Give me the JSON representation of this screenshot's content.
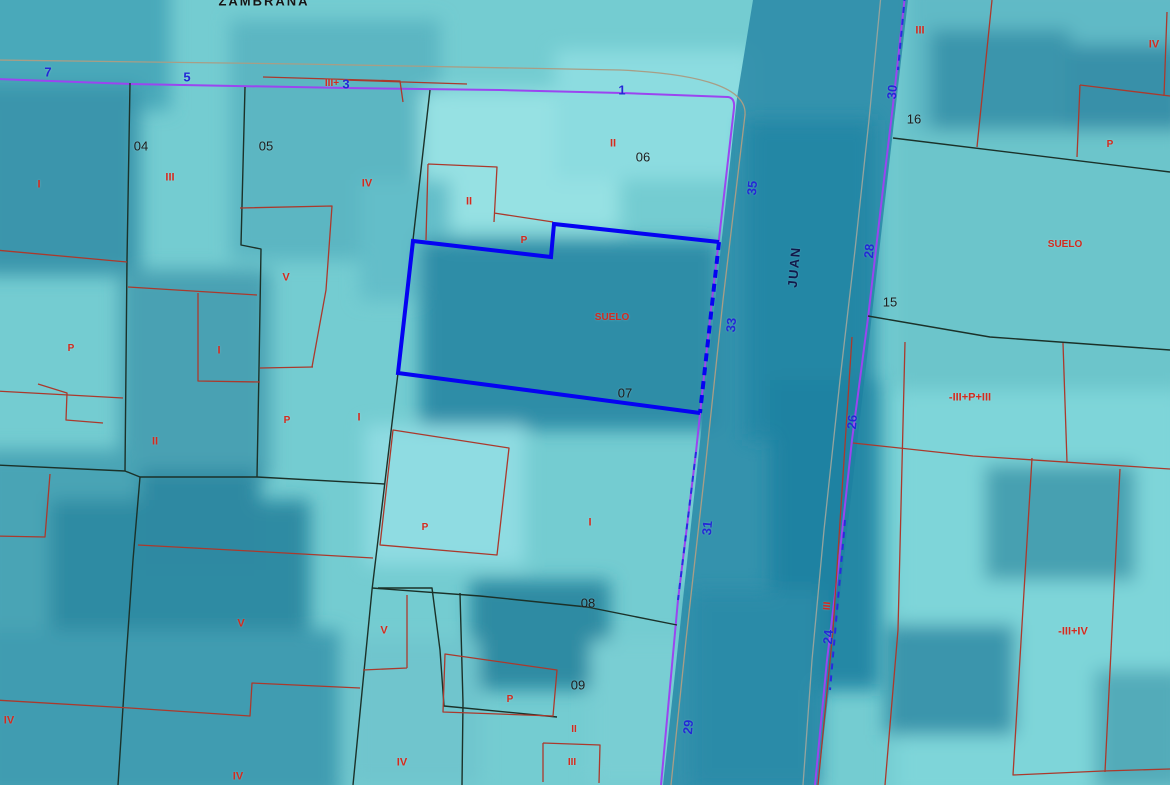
{
  "map": {
    "street_vertical": "JUAN",
    "street_top": "ZAMBRANA",
    "selected_parcel": {
      "number": "07",
      "land_use_label": "SUELO"
    },
    "colors": {
      "background": "#74ccd1",
      "black_line": "#1b3129",
      "red_line": "#ab392c",
      "label_red": "#d42a1e",
      "purple": "#9b45f0",
      "dash_blue": "#2a2ae0",
      "sel_blue": "#0503f2",
      "street_number_blue": "#2329d6",
      "street_name_navy": "#12194a",
      "parcel_number_black": "#1d1d1d",
      "casing_tan": "#a89e86",
      "casing_gray": "#95a49e"
    },
    "label_styles": {
      "parcel_numbers": {
        "color_key": "parcel_number_black",
        "size": 13,
        "weight": 400,
        "interactable": true,
        "name": "parcel-number-label"
      },
      "street_numbers": {
        "color_key": "street_number_blue",
        "size": 13,
        "weight": 700,
        "interactable": false,
        "name": "street-number-label"
      },
      "street_names": {
        "color_key": "street_name_navy",
        "size": 13,
        "weight": 700,
        "interactable": false,
        "name": "street-name-label",
        "spacing": 1.5
      },
      "construction_labels": {
        "color_key": "label_red",
        "size": 11,
        "weight": 700,
        "interactable": false,
        "name": "construction-label"
      }
    },
    "labels": {
      "parcel_numbers": [
        {
          "t": "04",
          "x": 141,
          "y": 146
        },
        {
          "t": "05",
          "x": 266,
          "y": 146
        },
        {
          "t": "06",
          "x": 643,
          "y": 157
        },
        {
          "t": "07",
          "x": 625,
          "y": 393
        },
        {
          "t": "08",
          "x": 588,
          "y": 603
        },
        {
          "t": "09",
          "x": 578,
          "y": 685
        },
        {
          "t": "15",
          "x": 890,
          "y": 302
        },
        {
          "t": "16",
          "x": 914,
          "y": 119
        }
      ],
      "street_numbers": [
        {
          "t": "7",
          "x": 48,
          "y": 72
        },
        {
          "t": "5",
          "x": 187,
          "y": 77
        },
        {
          "t": "3",
          "x": 346,
          "y": 84
        },
        {
          "t": "1",
          "x": 622,
          "y": 90
        },
        {
          "t": "35",
          "x": 752,
          "y": 188,
          "r": -85
        },
        {
          "t": "33",
          "x": 731,
          "y": 325,
          "r": -85
        },
        {
          "t": "31",
          "x": 707,
          "y": 528,
          "r": -85
        },
        {
          "t": "29",
          "x": 688,
          "y": 727,
          "r": -85
        },
        {
          "t": "30",
          "x": 892,
          "y": 92,
          "r": -85
        },
        {
          "t": "28",
          "x": 869,
          "y": 251,
          "r": -85
        },
        {
          "t": "26",
          "x": 852,
          "y": 422,
          "r": -85
        },
        {
          "t": "24",
          "x": 828,
          "y": 637,
          "r": -85
        }
      ],
      "street_names": [
        {
          "t": "JUAN",
          "x": 794,
          "y": 267,
          "r": -85
        },
        {
          "t": "ZAMBRANA",
          "x": 264,
          "y": 1,
          "c": "#151515",
          "sp": 2
        }
      ],
      "construction_labels": [
        {
          "t": "I",
          "x": 39,
          "y": 185
        },
        {
          "t": "III",
          "x": 170,
          "y": 178
        },
        {
          "t": "IV",
          "x": 367,
          "y": 184
        },
        {
          "t": "II",
          "x": 469,
          "y": 202
        },
        {
          "t": "II",
          "x": 613,
          "y": 144
        },
        {
          "t": "V",
          "x": 286,
          "y": 278
        },
        {
          "t": "P",
          "x": 71,
          "y": 349,
          "s": 10
        },
        {
          "t": "I",
          "x": 219,
          "y": 351
        },
        {
          "t": "P",
          "x": 287,
          "y": 421,
          "s": 10
        },
        {
          "t": "I",
          "x": 359,
          "y": 418
        },
        {
          "t": "II",
          "x": 155,
          "y": 442
        },
        {
          "t": "P",
          "x": 524,
          "y": 241,
          "s": 10
        },
        {
          "t": "SUELO",
          "x": 612,
          "y": 318,
          "s": 10
        },
        {
          "t": "I",
          "x": 590,
          "y": 523
        },
        {
          "t": "P",
          "x": 425,
          "y": 528,
          "s": 10
        },
        {
          "t": "V",
          "x": 241,
          "y": 624
        },
        {
          "t": "V",
          "x": 384,
          "y": 631
        },
        {
          "t": "IV",
          "x": 9,
          "y": 721
        },
        {
          "t": "IV",
          "x": 238,
          "y": 777
        },
        {
          "t": "IV",
          "x": 402,
          "y": 763
        },
        {
          "t": "P",
          "x": 510,
          "y": 700,
          "s": 10
        },
        {
          "t": "II",
          "x": 574,
          "y": 730,
          "s": 10
        },
        {
          "t": "III",
          "x": 572,
          "y": 763,
          "s": 10
        },
        {
          "t": "III+",
          "x": 332,
          "y": 84,
          "s": 10
        },
        {
          "t": "III",
          "x": 828,
          "y": 606,
          "s": 10,
          "r": -85
        },
        {
          "t": "III",
          "x": 920,
          "y": 31
        },
        {
          "t": "IV",
          "x": 1154,
          "y": 45
        },
        {
          "t": "P",
          "x": 1110,
          "y": 145,
          "s": 10
        },
        {
          "t": "SUELO",
          "x": 1065,
          "y": 245,
          "s": 10
        },
        {
          "t": "-III+P+III",
          "x": 970,
          "y": 398
        },
        {
          "t": "-III+IV",
          "x": 1073,
          "y": 632
        }
      ]
    }
  }
}
